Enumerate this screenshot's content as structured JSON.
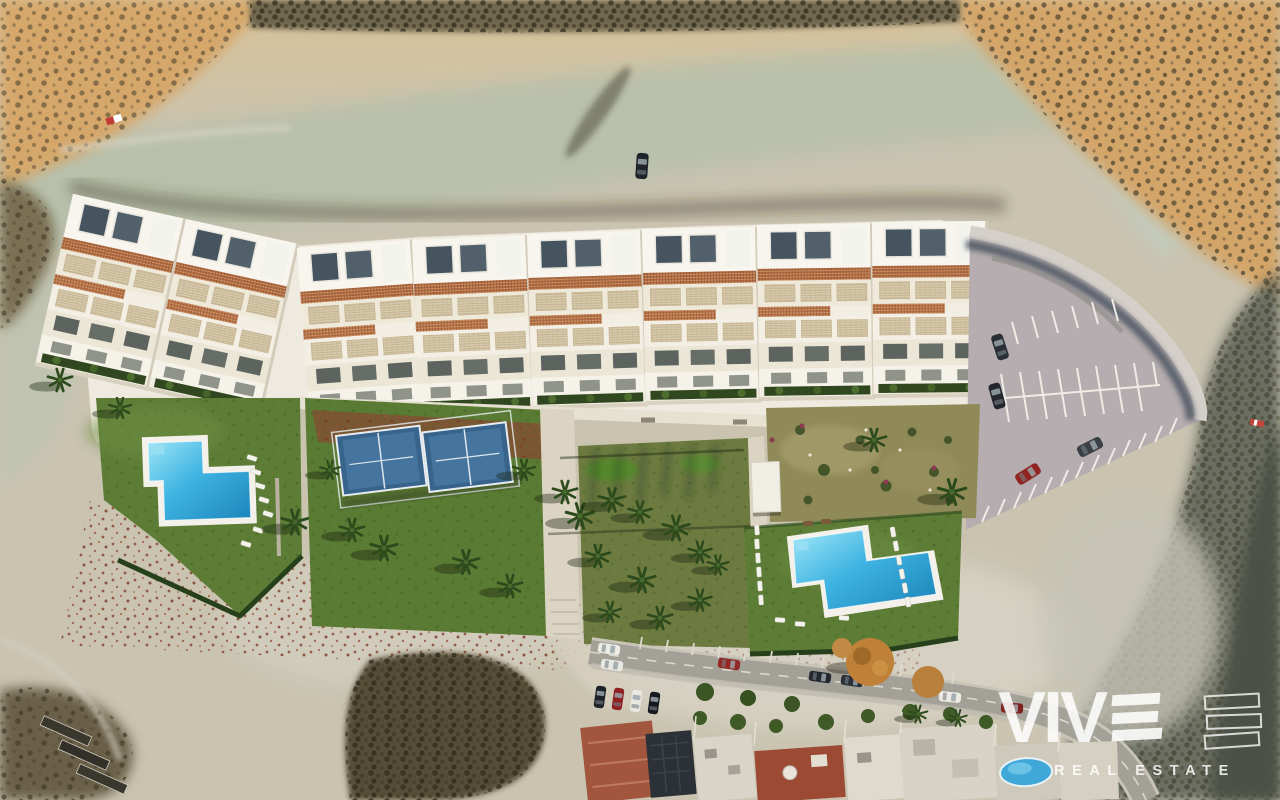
{
  "watermark": {
    "wordmark_prefix": "VIV",
    "stylized_letter": "E",
    "stylized_letter_bars": 3,
    "echo_outline_bars": 3,
    "tagline": "REAL ESTATE",
    "color": "#ffffff"
  },
  "scene": {
    "type": "aerial-drone-render",
    "setting": "new-build apartment complex on desert badlands at golden hour, existing street with houses below",
    "features": {
      "apartment_blocks": 8,
      "resort_pools": 2,
      "padel_courts": 2,
      "parking_lot": 1,
      "neighborhood_pool": 1,
      "parked_cars_street": 10,
      "sun_loungers": 20
    }
  },
  "palette": {
    "sand_pale": "#cbc5b2",
    "sand_gold": "#d4a569",
    "gully_green": "#b6c0ab",
    "scrub_dark": "#4f4836",
    "rust_speckle": "#8a4430",
    "building_white": "#f2eee3",
    "trellis_tan": "#ae6a42",
    "skylight_gray": "#46545f",
    "grass_green": "#5d7d37",
    "hedge_dark": "#27401c",
    "pool_blue_light": "#8fe0f4",
    "pool_blue_deep": "#1d86bc",
    "padel_blue": "#38648c",
    "parking_asphalt": "#b5adaf",
    "street_gray": "#a3a098",
    "terracotta_roof": "#a2563e",
    "shadow_slope": "#5f6456"
  }
}
